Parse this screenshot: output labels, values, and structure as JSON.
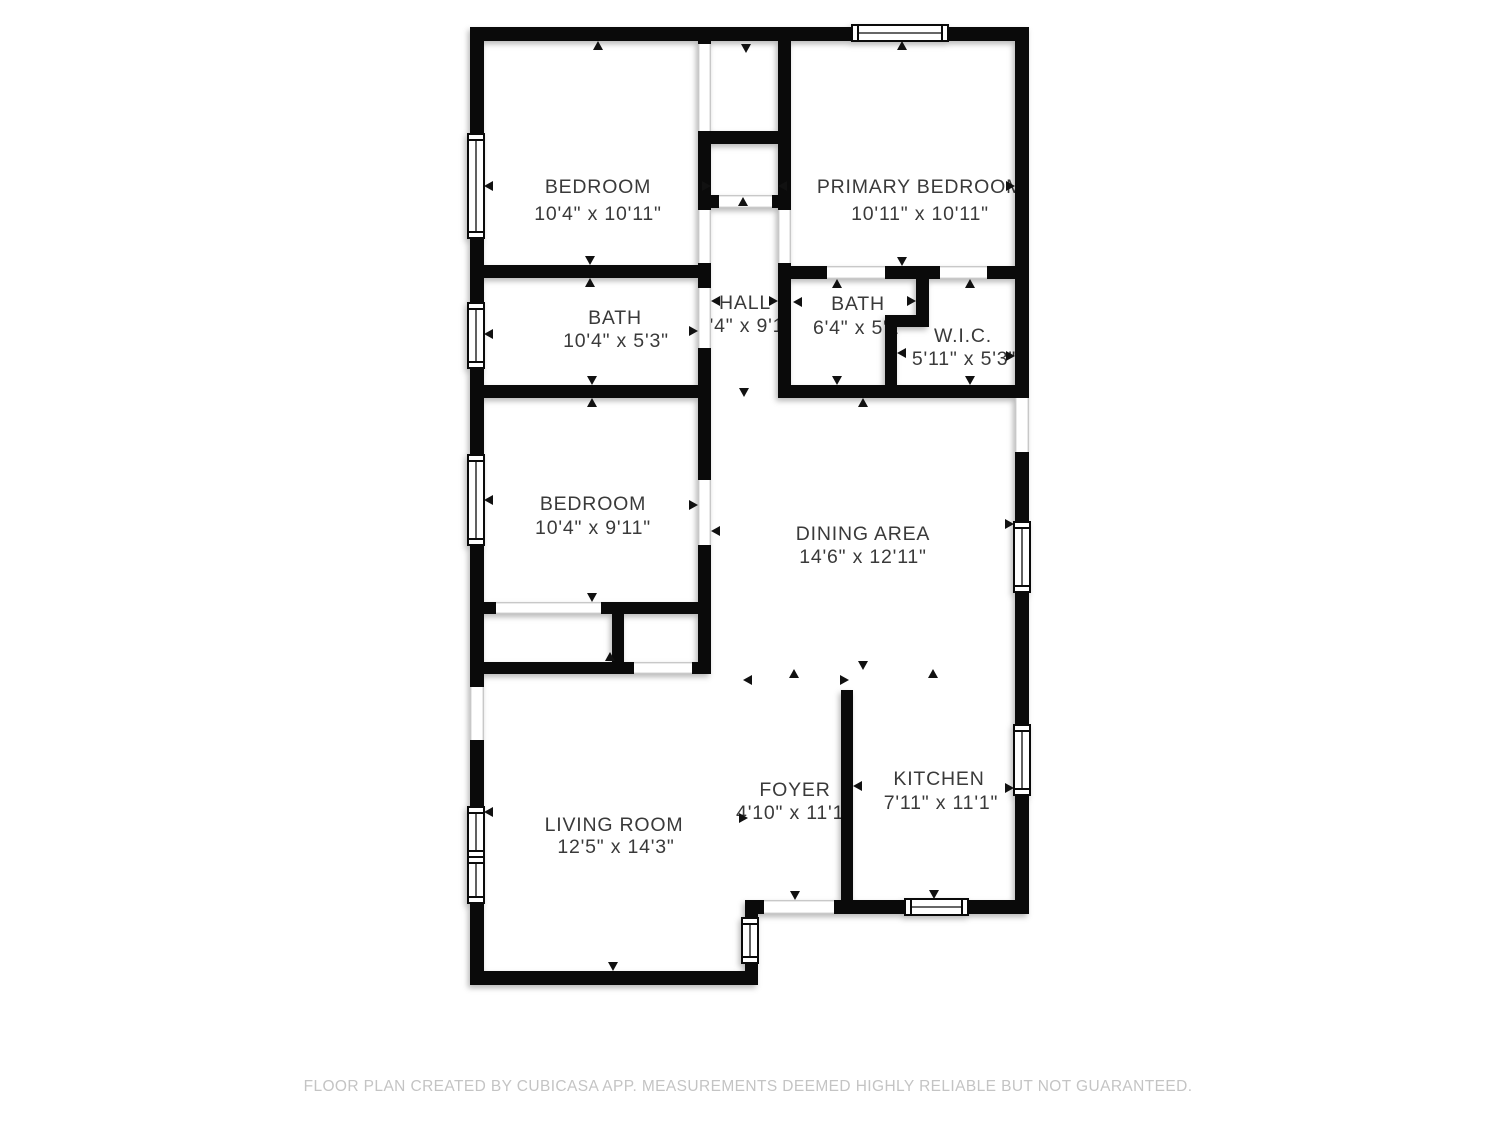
{
  "floorplan": {
    "rooms": [
      {
        "name": "BEDROOM",
        "dims": "10'4\" x 10'11\""
      },
      {
        "name": "PRIMARY BEDROOM",
        "dims": "10'11\" x 10'11\""
      },
      {
        "name": "BATH",
        "dims": "10'4\" x 5'3\""
      },
      {
        "name": "HALL",
        "dims": "3'4\" x 9'1\""
      },
      {
        "name": "BATH",
        "dims": "6'4\" x 5'2\""
      },
      {
        "name": "W.I.C.",
        "dims": "5'11\" x 5'3\""
      },
      {
        "name": "BEDROOM",
        "dims": "10'4\" x 9'11\""
      },
      {
        "name": "DINING AREA",
        "dims": "14'6\" x 12'11\""
      },
      {
        "name": "LIVING ROOM",
        "dims": "12'5\" x 14'3\""
      },
      {
        "name": "FOYER",
        "dims": "4'10\" x 11'1\""
      },
      {
        "name": "KITCHEN",
        "dims": "7'11\" x 11'1\""
      }
    ],
    "footer": {
      "disclaimer": "FLOOR PLAN CREATED BY CUBICASA APP. MEASUREMENTS DEEMED HIGHLY RELIABLE BUT NOT GUARANTEED."
    },
    "colors": {
      "wall": "#0a0a0a",
      "label": "#3a3a3a",
      "footer_text": "#c4c4c4",
      "background": "#ffffff",
      "opening_line": "#c8c8c8"
    }
  }
}
